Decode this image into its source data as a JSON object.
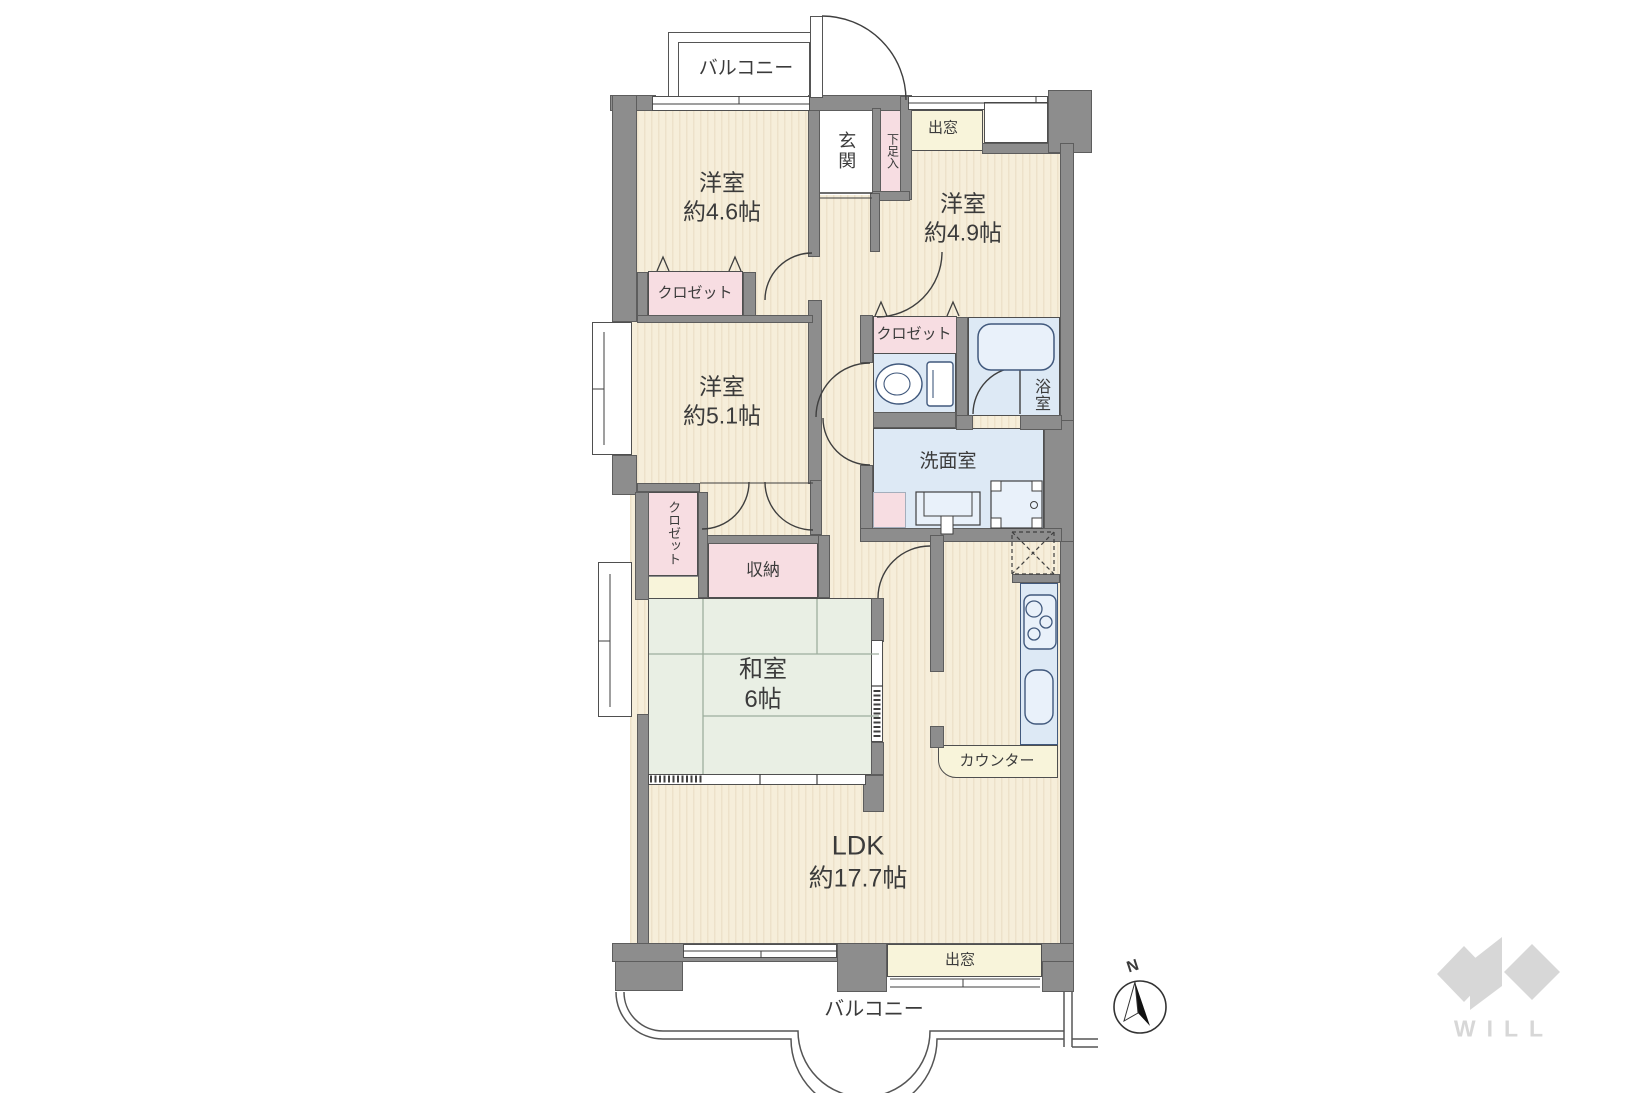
{
  "plan": {
    "rooms": {
      "balcony_top": {
        "label": "バルコニー"
      },
      "room_46": {
        "name": "洋室",
        "size": "約4.6帖"
      },
      "room_49": {
        "name": "洋室",
        "size": "約4.9帖"
      },
      "room_51": {
        "name": "洋室",
        "size": "約5.1帖"
      },
      "entrance": {
        "label": "玄関"
      },
      "shoe_cabinet": {
        "label": "下足入"
      },
      "bay_window_top": {
        "label": "出窓"
      },
      "closet_46": {
        "label": "クロゼット"
      },
      "closet_49": {
        "label": "クロゼット"
      },
      "closet_51": {
        "label": "クロゼット"
      },
      "bathroom": {
        "label": "浴室"
      },
      "washroom": {
        "label": "洗面室"
      },
      "storage": {
        "label": "収納"
      },
      "japanese_room": {
        "name": "和室",
        "size": "6帖"
      },
      "counter": {
        "label": "カウンター"
      },
      "ldk": {
        "name": "LDK",
        "size": "約17.7帖"
      },
      "bay_window_bottom": {
        "label": "出窓"
      },
      "balcony_bottom": {
        "label": "バルコニー"
      }
    },
    "compass": {
      "north_label": "N"
    },
    "brand": {
      "logo_text": "WILL"
    },
    "colors": {
      "wall": "#8d8d8d",
      "floor_cream": "#f6eeda",
      "tatami_green": "#e9efe4",
      "closet_pink": "#f7dde2",
      "wet_area_blue": "#dde9f5",
      "bay_window_pale": "#f8f4da",
      "line": "#4f4f4f",
      "logo_gray": "#d7d7d7"
    }
  }
}
